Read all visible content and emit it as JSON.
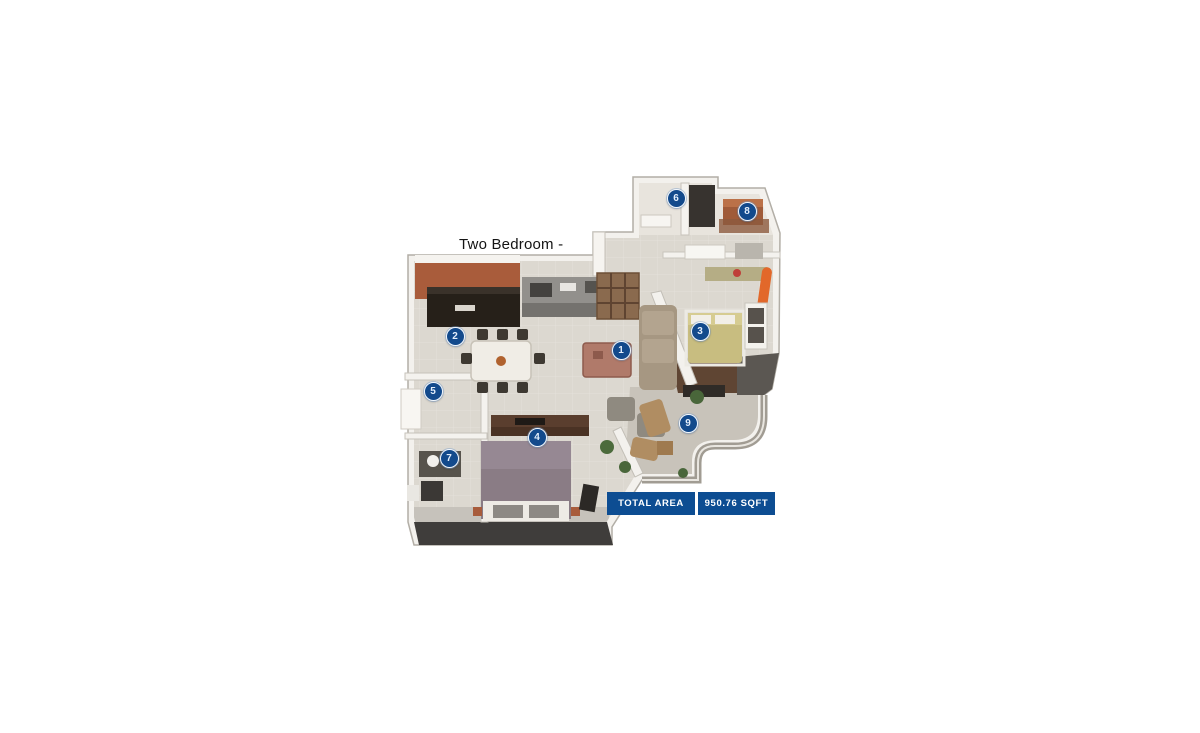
{
  "page": {
    "background": "#ffffff"
  },
  "plan": {
    "title": "Two Bedroom -",
    "total_area": {
      "label": "TOTAL AREA",
      "value": "950.76 SQFT"
    }
  },
  "colors": {
    "marker_fill": "#134a8c",
    "marker_ring": "#f2f7fd",
    "marker_text": "#e4effc",
    "bar_blue": "#0d4d92",
    "bar_text": "#ffffff",
    "title_text": "#141414"
  },
  "markers": [
    {
      "number": "1",
      "x": 621,
      "y": 350
    },
    {
      "number": "2",
      "x": 455,
      "y": 336
    },
    {
      "number": "3",
      "x": 700,
      "y": 331
    },
    {
      "number": "4",
      "x": 537,
      "y": 437
    },
    {
      "number": "5",
      "x": 433,
      "y": 391
    },
    {
      "number": "6",
      "x": 676,
      "y": 198
    },
    {
      "number": "7",
      "x": 449,
      "y": 458
    },
    {
      "number": "8",
      "x": 747,
      "y": 211
    },
    {
      "number": "9",
      "x": 688,
      "y": 423
    }
  ]
}
